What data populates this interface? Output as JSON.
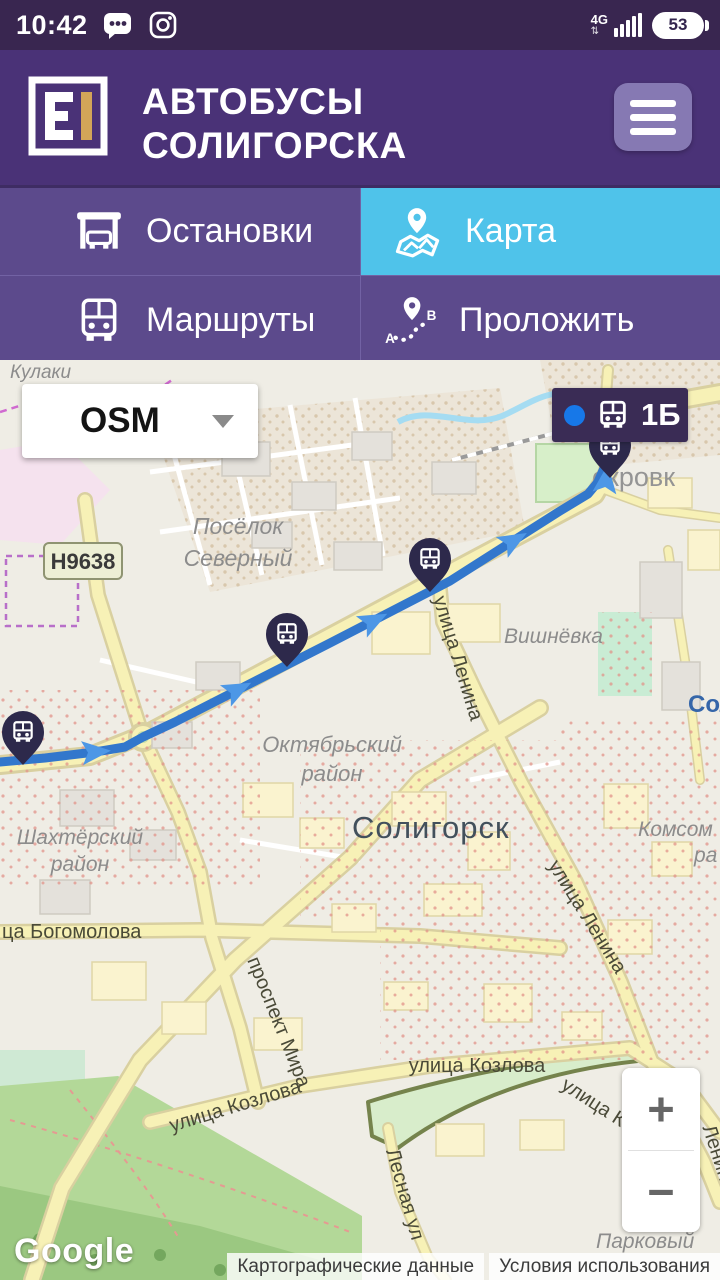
{
  "status_bar": {
    "time": "10:42",
    "network": "4G",
    "battery_percent": "53"
  },
  "header": {
    "app_title_line1": "АВТОБУСЫ",
    "app_title_line2": "СОЛИГОРСКА"
  },
  "tabs": {
    "stops": "Остановки",
    "map": "Карта",
    "routes": "Маршруты",
    "plan": "Проложить"
  },
  "plan_icon": {
    "from": "A",
    "to": "B"
  },
  "colors": {
    "status_bar": "#392650",
    "header": "#4A3277",
    "tab_inactive": "#5C4A8C",
    "tab_active": "#4FC3EA",
    "menu_button": "#8679B3",
    "logo_gold": "#D3A558",
    "route_blue": "#3277CC",
    "marker_navy": "#2D294B",
    "badge_bg": "#3A2C55",
    "badge_dot": "#1778E8"
  },
  "map": {
    "layer_selector_value": "OSM",
    "bus_route_badge": {
      "route_number": "1Б"
    },
    "zoom_in": "+",
    "zoom_out": "−",
    "google_logo": "Google",
    "attribution": {
      "map_data": "Картографические данные",
      "terms": "Условия использования"
    },
    "route": {
      "color": "#3277CC",
      "points": "0,402 45,398 95,392 125,387 143,377 175,362 330,283 450,221 560,151 588,134 598,122 604,108 606,96"
    },
    "bus_markers": [
      {
        "x": 23,
        "y": 375
      },
      {
        "x": 287,
        "y": 277
      },
      {
        "x": 430,
        "y": 202
      },
      {
        "x": 610,
        "y": 88
      }
    ],
    "labels": {
      "village_top": "Кулаки",
      "road_ref": "Н9638",
      "district_north_1": "Посёлок",
      "district_north_2": "Северный",
      "suburb_vishnevka": "Вишнёвка",
      "suburb_pokrovka": "окровк",
      "district_oktyabrsky_1": "Октябрьский",
      "district_oktyabrsky_2": "район",
      "city": "Солигорск",
      "label_sol_partial": "Сол",
      "district_shakhtyorsky_1": "Шахтёрский",
      "district_shakhtyorsky_2": "район",
      "district_komsomolsky_1": "Комсом",
      "district_komsomolsky_2": "ра",
      "street_bogomolova": "ца Богомолова",
      "street_lenina_upper": "улица Ленина",
      "street_lenina_lower": "улица Ленина",
      "street_lenina_right": "Ленина",
      "avenue_mira": "проспект Мира",
      "street_kozlova_horizontal": "улица Козлова",
      "street_kozlova_diagonal": "улица Ко",
      "street_kozlova_left": "улица Козлова",
      "street_lesnaya": "Лесная ул",
      "district_parkovy": "Парковый"
    }
  }
}
